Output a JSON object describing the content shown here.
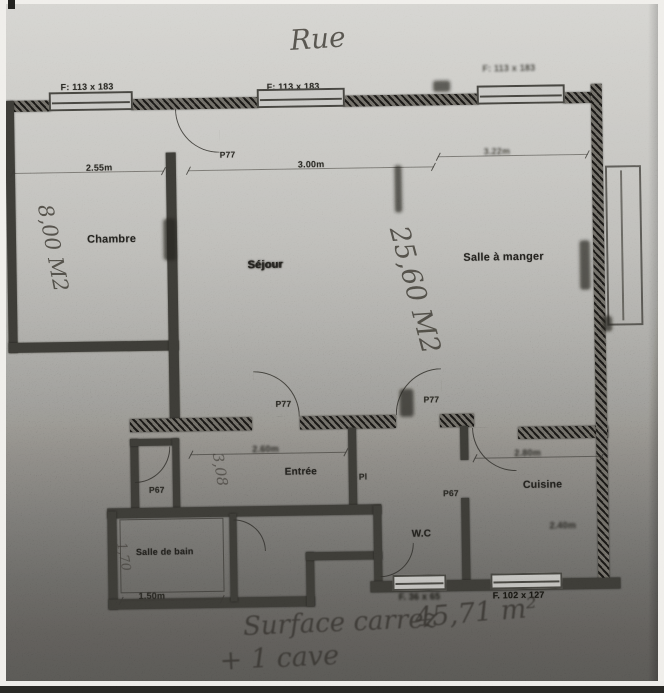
{
  "street_label": "Rue",
  "window_labels": {
    "top_left": "F: 113 x 183",
    "top_center": "F: 113 x 183",
    "top_right": "F: 113 x 183",
    "bottom_left": "F. 36 x 65",
    "bottom_right": "F. 102 x 127"
  },
  "rooms": {
    "chambre": {
      "label": "Chambre",
      "area": "8,00 M2",
      "width": "2.55m"
    },
    "sejour": {
      "label": "Séjour",
      "area": "25,60 M2",
      "width": "3.00m"
    },
    "salle_a_manger": {
      "label": "Salle à manger",
      "width": "3.22m"
    },
    "entree": {
      "label": "Entrée",
      "area": "3,08",
      "width": "2.60m"
    },
    "cuisine": {
      "label": "Cuisine",
      "width": "2.80m",
      "depth": "2.40m"
    },
    "wc": {
      "label": "W.C"
    },
    "salle_de_bain": {
      "label": "Salle de bain",
      "area": "1,70",
      "width": "1.50m"
    }
  },
  "door_labels": {
    "chambre": "P77",
    "sejour_left": "P77",
    "sejour_right": "P77",
    "closet": "P67",
    "placard": "Pl",
    "cuisine": "P67"
  },
  "annotations": {
    "surface": "Surface carrez",
    "surface_value": "45,71 m²",
    "cave": "+ 1 cave"
  },
  "colors": {
    "paper_light": "#cbcac5",
    "paper_dark": "#4b4a47",
    "wall_ink": "#33322e",
    "pencil": "#38362f"
  }
}
